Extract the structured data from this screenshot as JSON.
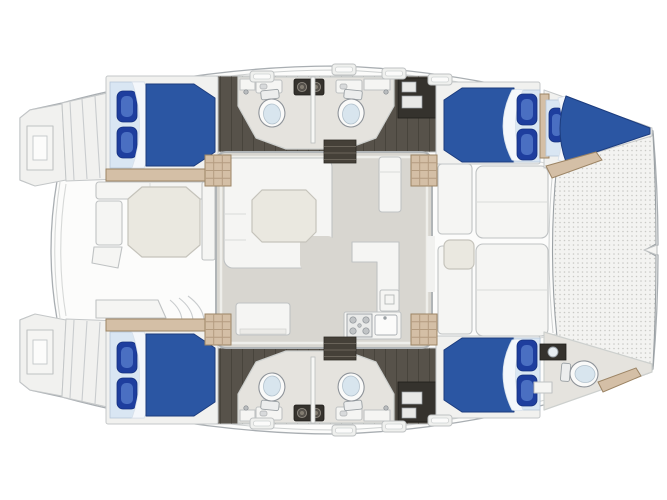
{
  "meta": {
    "description": "Top-down floor plan of a sailing catamaran (bow to the right, stern to the left)",
    "visible_text": []
  },
  "colors": {
    "bg": "#ffffff",
    "hull_white": "#fcfcfb",
    "outline_grey": "#a9aeb2",
    "bed_blue": "#2b56a3",
    "bed_blue_dark": "#1c3c7e",
    "pillow_blue": "#1e3e9e",
    "bed_light": "#d9e6f3",
    "wood": "#57524a",
    "charcoal": "#35322d",
    "tan": "#d4bfa6",
    "tan_dark": "#9c8464",
    "table_cream": "#eae8e0",
    "saloon_floor": "#d8d6d0",
    "heads_floor": "#e5e3de",
    "trampoline_bg": "#f3f3f1",
    "trampoline_dot": "#c9c9c5"
  },
  "layout": {
    "orientation": {
      "bow": "right",
      "stern": "left"
    },
    "trampoline": {
      "position": "bow",
      "texture": "mesh"
    },
    "foredeck": {
      "sun_cushions": 2,
      "side_benches": 2,
      "small_table": 1
    },
    "saloon": {
      "sofa": "U-shaped lounge, forward-port corner",
      "saloon_table": 1,
      "galley": {
        "stove_burners": 4,
        "sink": 1,
        "counter": "L-shaped",
        "appliance": 1
      },
      "fridge_cabinet": 1,
      "aft_cabinet": 1,
      "companionway_steps": 2
    },
    "cockpit_aft": {
      "table": "octagonal",
      "benches": 3,
      "curved_steps": 3
    },
    "transoms": {
      "count": 2,
      "swim_ladder": 2,
      "steps_per_transom": 4
    },
    "hulls": [
      {
        "name": "hull-top",
        "aft_cabin": {
          "double_bed": true,
          "pillows": 2
        },
        "heads_midship": {
          "toilets": 2,
          "double_sink_console": 1,
          "hand_sinks": 2
        },
        "forward_cabin": {
          "double_bed": true,
          "pillows": 2
        },
        "forepeak": {
          "crew_berth": true,
          "pillows": 1
        }
      },
      {
        "name": "hull-bottom",
        "aft_cabin": {
          "double_bed": true,
          "pillows": 2
        },
        "heads_midship": {
          "toilets": 2,
          "double_sink_console": 1,
          "hand_sinks": 2
        },
        "forward_cabin": {
          "double_bed": true,
          "pillows": 2
        },
        "forepeak": {
          "bow_head": true,
          "toilet": 1,
          "sink": 1
        }
      }
    ],
    "totals": {
      "double_cabins": 4,
      "single_berths": 1,
      "toilets": 5,
      "deck_hatches": 8,
      "companionway_step_grids": 4
    }
  }
}
